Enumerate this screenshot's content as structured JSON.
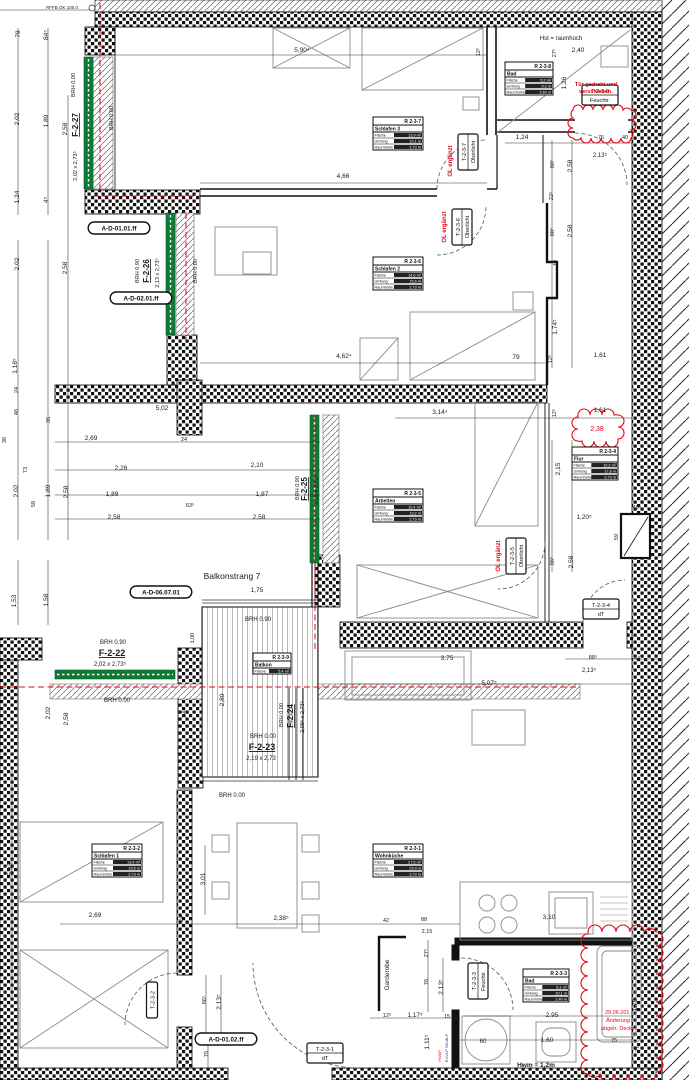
{
  "drawing": {
    "type": "Grundriss Wohnungsplan",
    "balcony_note": "Balkonstrang 7",
    "colors": {
      "ink": "#1a1a1a",
      "red": "#e30613",
      "blue": "#2233bb",
      "green": "#0e7a33",
      "grey": "#8a8a8a"
    }
  },
  "labels": [
    {
      "t": "RFFB OK 100.0",
      "x": 62,
      "y": 9,
      "s": 4.5
    },
    {
      "t": "78",
      "x": 20,
      "y": 34,
      "r": -90
    },
    {
      "t": "84⁵",
      "x": 48,
      "y": 35,
      "r": -90
    },
    {
      "t": "2,02",
      "x": 19,
      "y": 119,
      "r": -90
    },
    {
      "t": "1,89",
      "x": 48,
      "y": 121,
      "r": -90
    },
    {
      "t": "2,58",
      "x": 67,
      "y": 129,
      "r": -90
    },
    {
      "t": "1,24",
      "x": 19,
      "y": 197,
      "r": -90
    },
    {
      "t": "4⁵",
      "x": 48,
      "y": 200,
      "r": -90
    },
    {
      "t": "2,02",
      "x": 19,
      "y": 264,
      "r": -90
    },
    {
      "t": "2,58",
      "x": 67,
      "y": 268,
      "r": -90
    },
    {
      "t": "1,18⁵",
      "x": 17,
      "y": 366,
      "r": -90
    },
    {
      "t": "24",
      "x": 18,
      "y": 390,
      "r": -90,
      "s": 5.5
    },
    {
      "t": "46",
      "x": 18,
      "y": 412,
      "r": -90,
      "s": 5.5
    },
    {
      "t": "36",
      "x": 6,
      "y": 440,
      "r": -90,
      "s": 5.5
    },
    {
      "t": "35",
      "x": 50,
      "y": 420,
      "r": -90,
      "s": 5.5
    },
    {
      "t": "73",
      "x": 27,
      "y": 470,
      "r": -90,
      "s": 5.5
    },
    {
      "t": "2,02",
      "x": 18,
      "y": 491,
      "r": -90
    },
    {
      "t": "1,89",
      "x": 50,
      "y": 491,
      "r": -90
    },
    {
      "t": "2,58",
      "x": 68,
      "y": 492,
      "r": -90
    },
    {
      "t": "58",
      "x": 35,
      "y": 504,
      "r": -90,
      "s": 5.5
    },
    {
      "t": "1,53",
      "x": 16,
      "y": 601,
      "r": -90
    },
    {
      "t": "1,58",
      "x": 48,
      "y": 600,
      "r": -90
    },
    {
      "t": "5,93⁴",
      "x": 12,
      "y": 868,
      "r": -90
    },
    {
      "t": "5,90⁴",
      "x": 302,
      "y": 52
    },
    {
      "t": "12⁵",
      "x": 480,
      "y": 52,
      "r": -90,
      "s": 5.5
    },
    {
      "t": "4,66",
      "x": 343,
      "y": 178
    },
    {
      "t": "4,62⁴",
      "x": 344,
      "y": 358
    },
    {
      "t": "3,14⁴",
      "x": 440,
      "y": 414
    },
    {
      "t": "79",
      "x": 516,
      "y": 359
    },
    {
      "t": "12⁵",
      "x": 552,
      "y": 359,
      "r": -90,
      "s": 5.5
    },
    {
      "t": "1,61",
      "x": 600,
      "y": 357
    },
    {
      "t": "1,61",
      "x": 600,
      "y": 412
    },
    {
      "t": "12⁵",
      "x": 556,
      "y": 413,
      "r": -90,
      "s": 5.5
    },
    {
      "t": "2,38",
      "x": 597,
      "y": 431,
      "c": "red",
      "s": 7
    },
    {
      "t": "Hst = raumhoch",
      "x": 561,
      "y": 40,
      "s": 6
    },
    {
      "t": "27⁵",
      "x": 556,
      "y": 53,
      "r": -90,
      "s": 5.5
    },
    {
      "t": "2,40",
      "x": 578,
      "y": 52
    },
    {
      "t": "1,26",
      "x": 566,
      "y": 83,
      "r": -90
    },
    {
      "t": "1,24",
      "x": 522,
      "y": 139
    },
    {
      "t": "76",
      "x": 601,
      "y": 139,
      "s": 5.5
    },
    {
      "t": "40",
      "x": 625,
      "y": 139,
      "s": 5.5
    },
    {
      "t": "2,13⁵",
      "x": 600,
      "y": 157,
      "s": 6
    },
    {
      "t": "88⁵",
      "x": 554,
      "y": 164,
      "r": -90,
      "s": 5.5
    },
    {
      "t": "2,58",
      "x": 572,
      "y": 166,
      "r": -90
    },
    {
      "t": "22⁵",
      "x": 553,
      "y": 196,
      "r": -90,
      "s": 5.5
    },
    {
      "t": "88⁵",
      "x": 554,
      "y": 232,
      "r": -90,
      "s": 5.5
    },
    {
      "t": "2,58",
      "x": 572,
      "y": 231,
      "r": -90
    },
    {
      "t": "19",
      "x": 557,
      "y": 263,
      "r": -90,
      "s": 5.5
    },
    {
      "t": "1,74⁵",
      "x": 557,
      "y": 327,
      "r": -90
    },
    {
      "t": "2,69",
      "x": 91,
      "y": 440
    },
    {
      "t": "5,02",
      "x": 162,
      "y": 410
    },
    {
      "t": "24",
      "x": 184,
      "y": 441,
      "s": 5.5
    },
    {
      "t": "2,26",
      "x": 121,
      "y": 470
    },
    {
      "t": "1,89",
      "x": 112,
      "y": 496
    },
    {
      "t": "2,58",
      "x": 114,
      "y": 519
    },
    {
      "t": "2,10",
      "x": 257,
      "y": 467
    },
    {
      "t": "1,87",
      "x": 262,
      "y": 496
    },
    {
      "t": "2,58",
      "x": 259,
      "y": 519
    },
    {
      "t": "63⁵",
      "x": 190,
      "y": 507,
      "s": 5.5
    },
    {
      "t": "2,15",
      "x": 560,
      "y": 469,
      "r": -90
    },
    {
      "t": "1,20⁵",
      "x": 584,
      "y": 519
    },
    {
      "t": "40⁵",
      "x": 637,
      "y": 509,
      "s": 5.5
    },
    {
      "t": "59",
      "x": 618,
      "y": 537,
      "r": -90,
      "s": 5.5
    },
    {
      "t": "86⁵",
      "x": 554,
      "y": 561,
      "r": -90,
      "s": 5.5
    },
    {
      "t": "2,58",
      "x": 573,
      "y": 562,
      "r": -90
    },
    {
      "t": "Balkonstrang 7",
      "x": 232,
      "y": 579,
      "s": 8.5
    },
    {
      "t": "1,75",
      "x": 257,
      "y": 592
    },
    {
      "t": "BRH 0.90",
      "x": 258,
      "y": 621,
      "s": 6
    },
    {
      "t": "1,00",
      "x": 194,
      "y": 638,
      "r": -90,
      "s": 5.5
    },
    {
      "t": "2,80",
      "x": 224,
      "y": 700,
      "r": -90
    },
    {
      "t": "24",
      "x": 186,
      "y": 714,
      "r": -90,
      "s": 5.5
    },
    {
      "t": "BRH 0.00",
      "x": 283,
      "y": 715,
      "r": -90,
      "s": 5.5
    },
    {
      "t": "F-2-24",
      "x": 293,
      "y": 716,
      "r": -90,
      "s": 8,
      "b": 1,
      "u": 1
    },
    {
      "t": "2,08⁵ x 2,73⁵",
      "x": 304,
      "y": 717,
      "r": -90,
      "s": 5.5
    },
    {
      "t": "BRH 0.00",
      "x": 263,
      "y": 738,
      "s": 6
    },
    {
      "t": "F-2-23",
      "x": 262,
      "y": 750,
      "s": 9,
      "b": 1,
      "u": 1
    },
    {
      "t": "2,19 x 2,73",
      "x": 261,
      "y": 760,
      "s": 6
    },
    {
      "t": "BRH 0.00",
      "x": 232,
      "y": 797,
      "s": 6
    },
    {
      "t": "BRH 0.90",
      "x": 113,
      "y": 644,
      "s": 6
    },
    {
      "t": "F-2-22",
      "x": 112,
      "y": 656,
      "s": 9,
      "b": 1,
      "u": 1
    },
    {
      "t": "2,02 x 2,73⁵",
      "x": 110,
      "y": 666,
      "s": 6
    },
    {
      "t": "BRH 0.00",
      "x": 117,
      "y": 702,
      "s": 6
    },
    {
      "t": "2,02",
      "x": 50,
      "y": 713,
      "r": -90
    },
    {
      "t": "2,58",
      "x": 68,
      "y": 719,
      "r": -90
    },
    {
      "t": "3,75",
      "x": 447,
      "y": 660
    },
    {
      "t": "88⁵",
      "x": 593,
      "y": 659,
      "s": 5.5
    },
    {
      "t": "44",
      "x": 637,
      "y": 660,
      "s": 5.5
    },
    {
      "t": "2,13⁵",
      "x": 589,
      "y": 672,
      "s": 6
    },
    {
      "t": "5,07⁵",
      "x": 489,
      "y": 685
    },
    {
      "t": "2,69",
      "x": 95,
      "y": 917
    },
    {
      "t": "3,01",
      "x": 205,
      "y": 879,
      "r": -90
    },
    {
      "t": "24",
      "x": 183,
      "y": 919,
      "r": -90,
      "s": 5.5
    },
    {
      "t": "2,38⁵",
      "x": 281,
      "y": 920
    },
    {
      "t": "42",
      "x": 386,
      "y": 922,
      "s": 5.5
    },
    {
      "t": "88",
      "x": 424,
      "y": 921,
      "s": 5.5
    },
    {
      "t": "2,15",
      "x": 427,
      "y": 933,
      "s": 5.5
    },
    {
      "t": "3,10",
      "x": 549,
      "y": 919
    },
    {
      "t": "27⁵",
      "x": 428,
      "y": 953,
      "r": -90,
      "s": 5.5
    },
    {
      "t": "76",
      "x": 428,
      "y": 982,
      "r": -90,
      "s": 5.5
    },
    {
      "t": "2,13⁵",
      "x": 443,
      "y": 987,
      "r": -90
    },
    {
      "t": "Garderobe",
      "x": 389,
      "y": 975,
      "r": -90,
      "s": 6.5
    },
    {
      "t": "12⁵",
      "x": 387,
      "y": 1017,
      "s": 5.5
    },
    {
      "t": "1,17⁵",
      "x": 415,
      "y": 1017
    },
    {
      "t": "15",
      "x": 447,
      "y": 1018,
      "s": 5.5
    },
    {
      "t": "1,11⁵",
      "x": 429,
      "y": 1042,
      "r": -90
    },
    {
      "t": "86⁵",
      "x": 206,
      "y": 1000,
      "r": -90,
      "s": 5.5
    },
    {
      "t": "2,13⁵",
      "x": 221,
      "y": 1002,
      "r": -90
    },
    {
      "t": "75",
      "x": 208,
      "y": 1054,
      "r": -90,
      "s": 5.5
    },
    {
      "t": "2,95",
      "x": 552,
      "y": 1017
    },
    {
      "t": "1,60",
      "x": 547,
      "y": 1042
    },
    {
      "t": "75",
      "x": 614,
      "y": 1042,
      "s": 5.5
    },
    {
      "t": "1,70",
      "x": 637,
      "y": 1005,
      "r": -90
    },
    {
      "t": "27",
      "x": 639,
      "y": 1049,
      "r": -90,
      "s": 5.5
    },
    {
      "t": "60",
      "x": 483,
      "y": 1043,
      "s": 6
    },
    {
      "t": "Hwm = 1,2m",
      "x": 536,
      "y": 1067,
      "s": 6.5,
      "b": 1
    },
    {
      "t": "HWAP",
      "x": 441,
      "y": 1056,
      "r": -90,
      "s": 4,
      "c": "red"
    },
    {
      "t": "EUVLP WLMLP",
      "x": 448,
      "y": 1048,
      "r": -90,
      "s": 4,
      "c": "blue"
    },
    {
      "t": "BRH 0.00",
      "x": 75,
      "y": 85,
      "r": -90,
      "s": 5.5
    },
    {
      "t": "F-2-27",
      "x": 78,
      "y": 125,
      "r": -90,
      "s": 8,
      "b": 1,
      "u": 1
    },
    {
      "t": "2,02 x 2,73⁵",
      "x": 77,
      "y": 166,
      "r": -90,
      "s": 5.5
    },
    {
      "t": "BRH 0.00",
      "x": 113,
      "y": 118,
      "r": -90,
      "s": 5.5
    },
    {
      "t": "BRH 0.90",
      "x": 139,
      "y": 271,
      "r": -90,
      "s": 5.5
    },
    {
      "t": "F-2-26",
      "x": 149,
      "y": 271,
      "r": -90,
      "s": 8,
      "b": 1,
      "u": 1
    },
    {
      "t": "2,13 x 2,73⁵",
      "x": 159,
      "y": 273,
      "r": -90,
      "s": 5.5
    },
    {
      "t": "BRH 0.00",
      "x": 197,
      "y": 271,
      "r": -90,
      "s": 5.5
    },
    {
      "t": "BRH 0.90",
      "x": 299,
      "y": 488,
      "r": -90,
      "s": 5.5
    },
    {
      "t": "F-2-25",
      "x": 307,
      "y": 489,
      "r": -90,
      "s": 8,
      "b": 1,
      "u": 1
    },
    {
      "t": "2,02 x 2,73⁵",
      "x": 318,
      "y": 490,
      "r": -90,
      "s": 5.5
    },
    {
      "t": "OL ergänzt",
      "x": 452,
      "y": 161,
      "r": -90,
      "s": 6,
      "c": "red",
      "b": 1
    },
    {
      "t": "OL ergänzt",
      "x": 446,
      "y": 227,
      "r": -90,
      "s": 6,
      "c": "red",
      "b": 1
    },
    {
      "t": "OL ergänzt",
      "x": 500,
      "y": 556,
      "r": -90,
      "s": 6,
      "c": "red",
      "b": 1
    },
    {
      "t": "Tür gedreht und",
      "x": 596,
      "y": 86,
      "s": 5.5,
      "c": "red",
      "b": 1
    },
    {
      "t": "verschieben.",
      "x": 596,
      "y": 93,
      "s": 5.5,
      "c": "red",
      "b": 1
    },
    {
      "t": "29.06.201.",
      "x": 618,
      "y": 1014,
      "s": 5.5,
      "c": "red"
    },
    {
      "t": "Änderung",
      "x": 618,
      "y": 1022,
      "s": 5.5,
      "c": "red"
    },
    {
      "t": "abgeh. Decke",
      "x": 618,
      "y": 1030,
      "s": 5.5,
      "c": "red"
    }
  ],
  "callouts": [
    {
      "t": "A-D-01.01.ff",
      "x": 119,
      "y": 228
    },
    {
      "t": "A-D-02.01.ff",
      "x": 141,
      "y": 298
    },
    {
      "t": "A-D-06.07.01",
      "x": 161,
      "y": 592
    },
    {
      "t": "A-D-01.02.ff",
      "x": 226,
      "y": 1039
    }
  ],
  "door_tags": [
    {
      "lines": [
        "T-2-3-8",
        "Feuchtr."
      ],
      "x": 600,
      "y": 95,
      "v": 0
    },
    {
      "lines": [
        "T-2-3-7",
        "Oberlicht"
      ],
      "x": 468,
      "y": 152,
      "v": 1
    },
    {
      "lines": [
        "T-2-3-6",
        "Oberlicht"
      ],
      "x": 462,
      "y": 227,
      "v": 1
    },
    {
      "lines": [
        "T-2-3-5",
        "Oberlicht"
      ],
      "x": 516,
      "y": 556,
      "v": 1
    },
    {
      "lines": [
        "T-2-3-4",
        "dT"
      ],
      "x": 601,
      "y": 609,
      "v": 0
    },
    {
      "lines": [
        "T-2-3-3",
        "Feuchtr."
      ],
      "x": 478,
      "y": 981,
      "v": 1
    },
    {
      "lines": [
        "T-2-3-2"
      ],
      "x": 152,
      "y": 1000,
      "v": 1
    },
    {
      "lines": [
        "T-2-3-1",
        "dT"
      ],
      "x": 325,
      "y": 1053,
      "v": 0
    }
  ],
  "room_tables": [
    {
      "id": "R 2-3-7",
      "name": "Schlafen 3",
      "x": 373,
      "y": 117,
      "rows": [
        [
          "Fläche",
          "13,9 m²"
        ],
        [
          "Umfang",
          "15,1 m"
        ],
        [
          "Raumhöhe",
          "2,73 m"
        ]
      ]
    },
    {
      "id": "R 2-3-8",
      "name": "Bad",
      "x": 505,
      "y": 62,
      "w": 48,
      "rows": [
        [
          "Fläche",
          "5,2 m²"
        ],
        [
          "Umfang",
          "9,3 m"
        ],
        [
          "Raumhöhe",
          "2,40 m"
        ]
      ]
    },
    {
      "id": "R 2-3-6",
      "name": "Schlafen 2",
      "x": 373,
      "y": 257,
      "rows": [
        [
          "Fläche",
          "14,6 m²"
        ],
        [
          "Umfang",
          "15,6 m"
        ],
        [
          "Raumhöhe",
          "2,73 m"
        ]
      ]
    },
    {
      "id": "R 2-3-5",
      "name": "Arbeiten",
      "x": 373,
      "y": 489,
      "rows": [
        [
          "Fläche",
          "10,4 m²"
        ],
        [
          "Umfang",
          "13,2 m"
        ],
        [
          "Raumhöhe",
          "2,73 m"
        ]
      ]
    },
    {
      "id": "R 2-3-4",
      "name": "Flur",
      "x": 572,
      "y": 447,
      "w": 46,
      "rows": [
        [
          "Fläche",
          "10,2 m²"
        ],
        [
          "Umfang",
          "17,8 m"
        ],
        [
          "Raumhöhe",
          "2,73 m"
        ]
      ]
    },
    {
      "id": "R 2-3-2",
      "name": "Schlafen 1",
      "x": 92,
      "y": 844,
      "rows": [
        [
          "Fläche",
          "13,4 m²"
        ],
        [
          "Umfang",
          "15,0 m"
        ],
        [
          "Raumhöhe",
          "2,73 m"
        ]
      ]
    },
    {
      "id": "R 2-3-1",
      "name": "Wohnküche",
      "x": 373,
      "y": 844,
      "rows": [
        [
          "Fläche",
          "27,5 m²"
        ],
        [
          "Umfang",
          "23,4 m"
        ],
        [
          "Raumhöhe",
          "2,73 m"
        ]
      ]
    },
    {
      "id": "R 2-3-3",
      "name": "Bad",
      "x": 523,
      "y": 969,
      "w": 46,
      "rows": [
        [
          "Fläche",
          "6,1 m²"
        ],
        [
          "Umfang",
          "10,1 m"
        ],
        [
          "Raumhöhe",
          "2,40 m"
        ]
      ]
    },
    {
      "id": "R 2-3-9",
      "name": "Balkon",
      "x": 253,
      "y": 653,
      "w": 38,
      "rows": [
        [
          "Fläche",
          "5,4 m²"
        ]
      ]
    }
  ]
}
